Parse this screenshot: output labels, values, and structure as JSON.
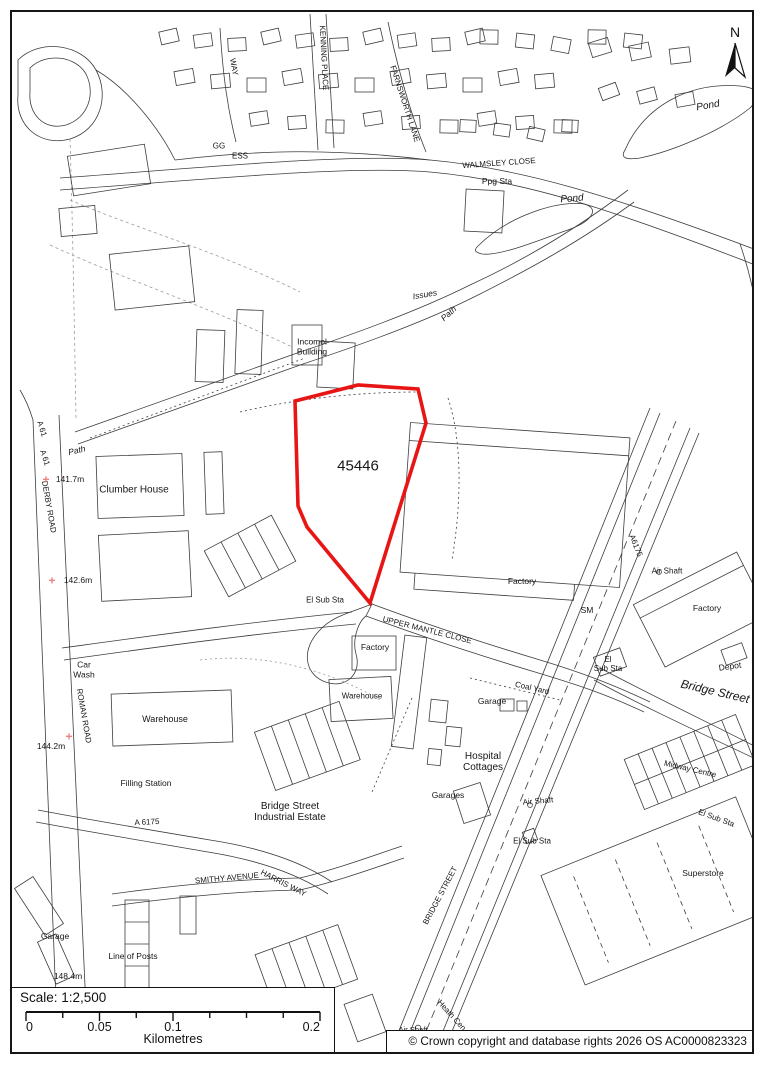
{
  "map": {
    "site_reference": "45446",
    "boundary_color": "#e81515",
    "cross_color": "#f08080",
    "line_color": "#3d3d3d",
    "north_label": "N",
    "labels": [
      {
        "t": "WAY",
        "x": 233,
        "y": 67,
        "r": 80,
        "fs": 8
      },
      {
        "t": "KENNING PLACE",
        "x": 323,
        "y": 58,
        "r": 87,
        "fs": 8
      },
      {
        "t": "FARNSWORTH LANE",
        "x": 404,
        "y": 104,
        "r": 72,
        "fs": 8
      },
      {
        "t": "GG",
        "x": 219,
        "y": 147,
        "r": 0,
        "fs": 8
      },
      {
        "t": "ESS",
        "x": 240,
        "y": 157,
        "r": 0,
        "fs": 8
      },
      {
        "t": "Pond",
        "x": 708,
        "y": 106,
        "r": -10,
        "fs": 10,
        "it": 1
      },
      {
        "t": "WALMSLEY CLOSE",
        "x": 499,
        "y": 164,
        "r": -4,
        "fs": 8
      },
      {
        "t": "Ppg Sta",
        "x": 497,
        "y": 182,
        "r": 0,
        "fs": 8.5
      },
      {
        "t": "Pond",
        "x": 572,
        "y": 199,
        "r": -5,
        "fs": 10,
        "it": 1
      },
      {
        "t": "Issues",
        "x": 425,
        "y": 295,
        "r": -10,
        "fs": 8.5,
        "it": 1
      },
      {
        "t": "Path",
        "x": 449,
        "y": 314,
        "r": -42,
        "fs": 8.5,
        "it": 1
      },
      {
        "t": "Incomol\nBuilding",
        "x": 312,
        "y": 347,
        "r": 0,
        "fs": 8.5
      },
      {
        "t": "A 61",
        "x": 41,
        "y": 429,
        "r": 72,
        "fs": 8
      },
      {
        "t": "A 61",
        "x": 44,
        "y": 458,
        "r": 72,
        "fs": 8
      },
      {
        "t": "Path",
        "x": 77,
        "y": 451,
        "r": -14,
        "fs": 8.5,
        "it": 1
      },
      {
        "t": "141.7m",
        "x": 70,
        "y": 480,
        "r": 0,
        "fs": 8.5
      },
      {
        "t": "Clumber House",
        "x": 134,
        "y": 490,
        "r": 0,
        "fs": 10
      },
      {
        "t": "DERBY ROAD",
        "x": 48,
        "y": 507,
        "r": 80,
        "fs": 8
      },
      {
        "t": "142.6m",
        "x": 78,
        "y": 581,
        "r": 0,
        "fs": 8.5
      },
      {
        "t": "45446",
        "x": 358,
        "y": 467,
        "r": 0,
        "fs": 15
      },
      {
        "t": "El Sub Sta",
        "x": 325,
        "y": 601,
        "r": 0,
        "fs": 8
      },
      {
        "t": "UPPER MANTLE CLOSE",
        "x": 427,
        "y": 631,
        "r": 14,
        "fs": 8
      },
      {
        "t": "Factory",
        "x": 522,
        "y": 582,
        "r": 0,
        "fs": 8.5
      },
      {
        "t": "SM",
        "x": 587,
        "y": 611,
        "r": 0,
        "fs": 8.5
      },
      {
        "t": "Factory",
        "x": 375,
        "y": 648,
        "r": 0,
        "fs": 8.5
      },
      {
        "t": "Warehouse",
        "x": 362,
        "y": 697,
        "r": 0,
        "fs": 8
      },
      {
        "t": "Coal Yard",
        "x": 532,
        "y": 689,
        "r": 13,
        "fs": 8
      },
      {
        "t": "Garage",
        "x": 492,
        "y": 702,
        "r": 0,
        "fs": 8.5
      },
      {
        "t": "A6175",
        "x": 635,
        "y": 546,
        "r": 68,
        "fs": 8
      },
      {
        "t": "Air Shaft",
        "x": 667,
        "y": 572,
        "r": 0,
        "fs": 8
      },
      {
        "t": "Factory",
        "x": 707,
        "y": 609,
        "r": 0,
        "fs": 8.5
      },
      {
        "t": "El\nSub Sta",
        "x": 608,
        "y": 665,
        "r": 0,
        "fs": 8
      },
      {
        "t": "Depot",
        "x": 730,
        "y": 667,
        "r": -8,
        "fs": 8.5
      },
      {
        "t": "Bridge Street",
        "x": 715,
        "y": 692,
        "r": 13,
        "fs": 12,
        "it": 1
      },
      {
        "t": "Car\nWash",
        "x": 84,
        "y": 670,
        "r": 0,
        "fs": 8.5
      },
      {
        "t": "ROMAN ROAD",
        "x": 83,
        "y": 716,
        "r": 80,
        "fs": 8
      },
      {
        "t": "Warehouse",
        "x": 165,
        "y": 719,
        "r": 0,
        "fs": 9
      },
      {
        "t": "144.2m",
        "x": 51,
        "y": 747,
        "r": 0,
        "fs": 8.5
      },
      {
        "t": "Filling Station",
        "x": 146,
        "y": 784,
        "r": 0,
        "fs": 8.5
      },
      {
        "t": "A 6175",
        "x": 147,
        "y": 823,
        "r": -3,
        "fs": 8
      },
      {
        "t": "Bridge Street\nIndustrial Estate",
        "x": 290,
        "y": 812,
        "r": 0,
        "fs": 10
      },
      {
        "t": "Hospital\nCottages",
        "x": 483,
        "y": 762,
        "r": 0,
        "fs": 10
      },
      {
        "t": "Garages",
        "x": 448,
        "y": 796,
        "r": 0,
        "fs": 8.5
      },
      {
        "t": "Air Shaft",
        "x": 538,
        "y": 802,
        "r": -5,
        "fs": 8
      },
      {
        "t": "El Sub Sta",
        "x": 532,
        "y": 842,
        "r": 0,
        "fs": 8
      },
      {
        "t": "Midway Centre",
        "x": 690,
        "y": 770,
        "r": 13,
        "fs": 8
      },
      {
        "t": "El Sub Sta",
        "x": 716,
        "y": 819,
        "r": 20,
        "fs": 8
      },
      {
        "t": "Superstore",
        "x": 703,
        "y": 874,
        "r": 0,
        "fs": 8.5
      },
      {
        "t": "SMITHY AVENUE",
        "x": 227,
        "y": 879,
        "r": -5,
        "fs": 8
      },
      {
        "t": "HARRIS WAY",
        "x": 283,
        "y": 884,
        "r": 27,
        "fs": 8
      },
      {
        "t": "Garage",
        "x": 55,
        "y": 937,
        "r": 0,
        "fs": 8.5
      },
      {
        "t": "Line of Posts",
        "x": 133,
        "y": 957,
        "r": 0,
        "fs": 8.5
      },
      {
        "t": "148.4m",
        "x": 68,
        "y": 977,
        "r": 0,
        "fs": 8.5
      },
      {
        "t": "BRIDGE STREET",
        "x": 441,
        "y": 896,
        "r": -62,
        "fs": 8
      },
      {
        "t": "Heath Cen",
        "x": 451,
        "y": 1016,
        "r": 48,
        "fs": 8
      },
      {
        "t": "Air Shaft",
        "x": 413,
        "y": 1030,
        "r": 0,
        "fs": 7.5
      }
    ],
    "crosses": [
      {
        "x": 46,
        "y": 480
      },
      {
        "x": 52,
        "y": 581
      },
      {
        "x": 69,
        "y": 737
      },
      {
        "x": 87,
        "y": 991
      }
    ],
    "scale": {
      "title": "Scale: 1:2,500",
      "unit": "Kilometres",
      "ticks": [
        {
          "label": "0",
          "frac": 0
        },
        {
          "label": "0.05",
          "frac": 0.25
        },
        {
          "label": "0.1",
          "frac": 0.5
        },
        {
          "label": "0.2",
          "frac": 1
        }
      ]
    },
    "copyright": "© Crown copyright and database rights 2026 OS AC0000823323"
  }
}
